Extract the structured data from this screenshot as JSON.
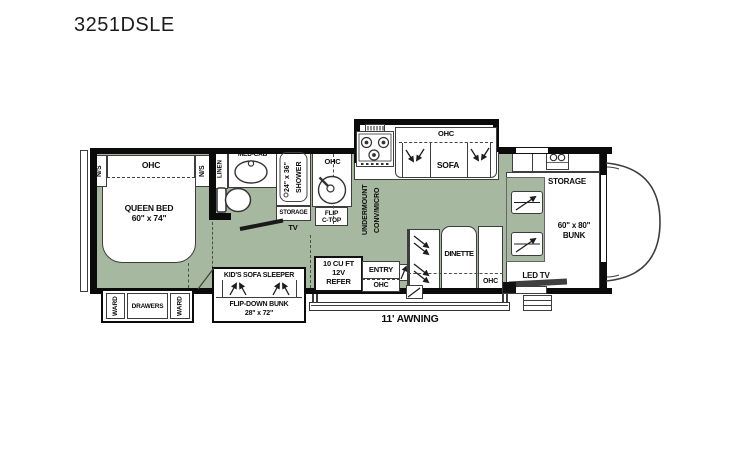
{
  "title": "3251DSLE",
  "colors": {
    "floor": "#a6b89f",
    "wall": "#000000",
    "outline": "#3d3d3d"
  },
  "labels": {
    "bedroom": {
      "ns_left": "N/S",
      "ohc": "OHC",
      "ns_right": "N/S",
      "bed1": "QUEEN BED",
      "bed2": "60\" x 74\""
    },
    "wardrobe": {
      "ward_left": "WARD",
      "drawers": "DRAWERS",
      "ward_right": "WARD"
    },
    "bath": {
      "linen": "LINEN",
      "med_cab": "MED-CAB",
      "shower_size": "24\" x 36\"",
      "shower": "SHOWER",
      "storage": "STORAGE",
      "tv": "TV"
    },
    "kitchen": {
      "ohc": "OHC",
      "flip1": "FLIP",
      "flip2": "C-TOP",
      "under1": "UNDERMOUNT",
      "under2": "CONV/MICRO"
    },
    "sofa": {
      "ohc": "OHC",
      "name": "SOFA"
    },
    "kids": {
      "name": "KID'S SOFA SLEEPER",
      "bunk1": "FLIP-DOWN BUNK",
      "bunk2": "28\" x 72\""
    },
    "refer": {
      "l1": "10 CU FT",
      "l2": "12V",
      "l3": "REFER"
    },
    "entry": {
      "name": "ENTRY",
      "ohc": "OHC"
    },
    "dinette": {
      "name": "DINETTE",
      "ohc": "OHC"
    },
    "front": {
      "storage": "STORAGE",
      "bunk1": "60\" x 80\"",
      "bunk2": "BUNK",
      "led_tv": "LED TV"
    },
    "awning": {
      "name": "11' AWNING"
    }
  }
}
